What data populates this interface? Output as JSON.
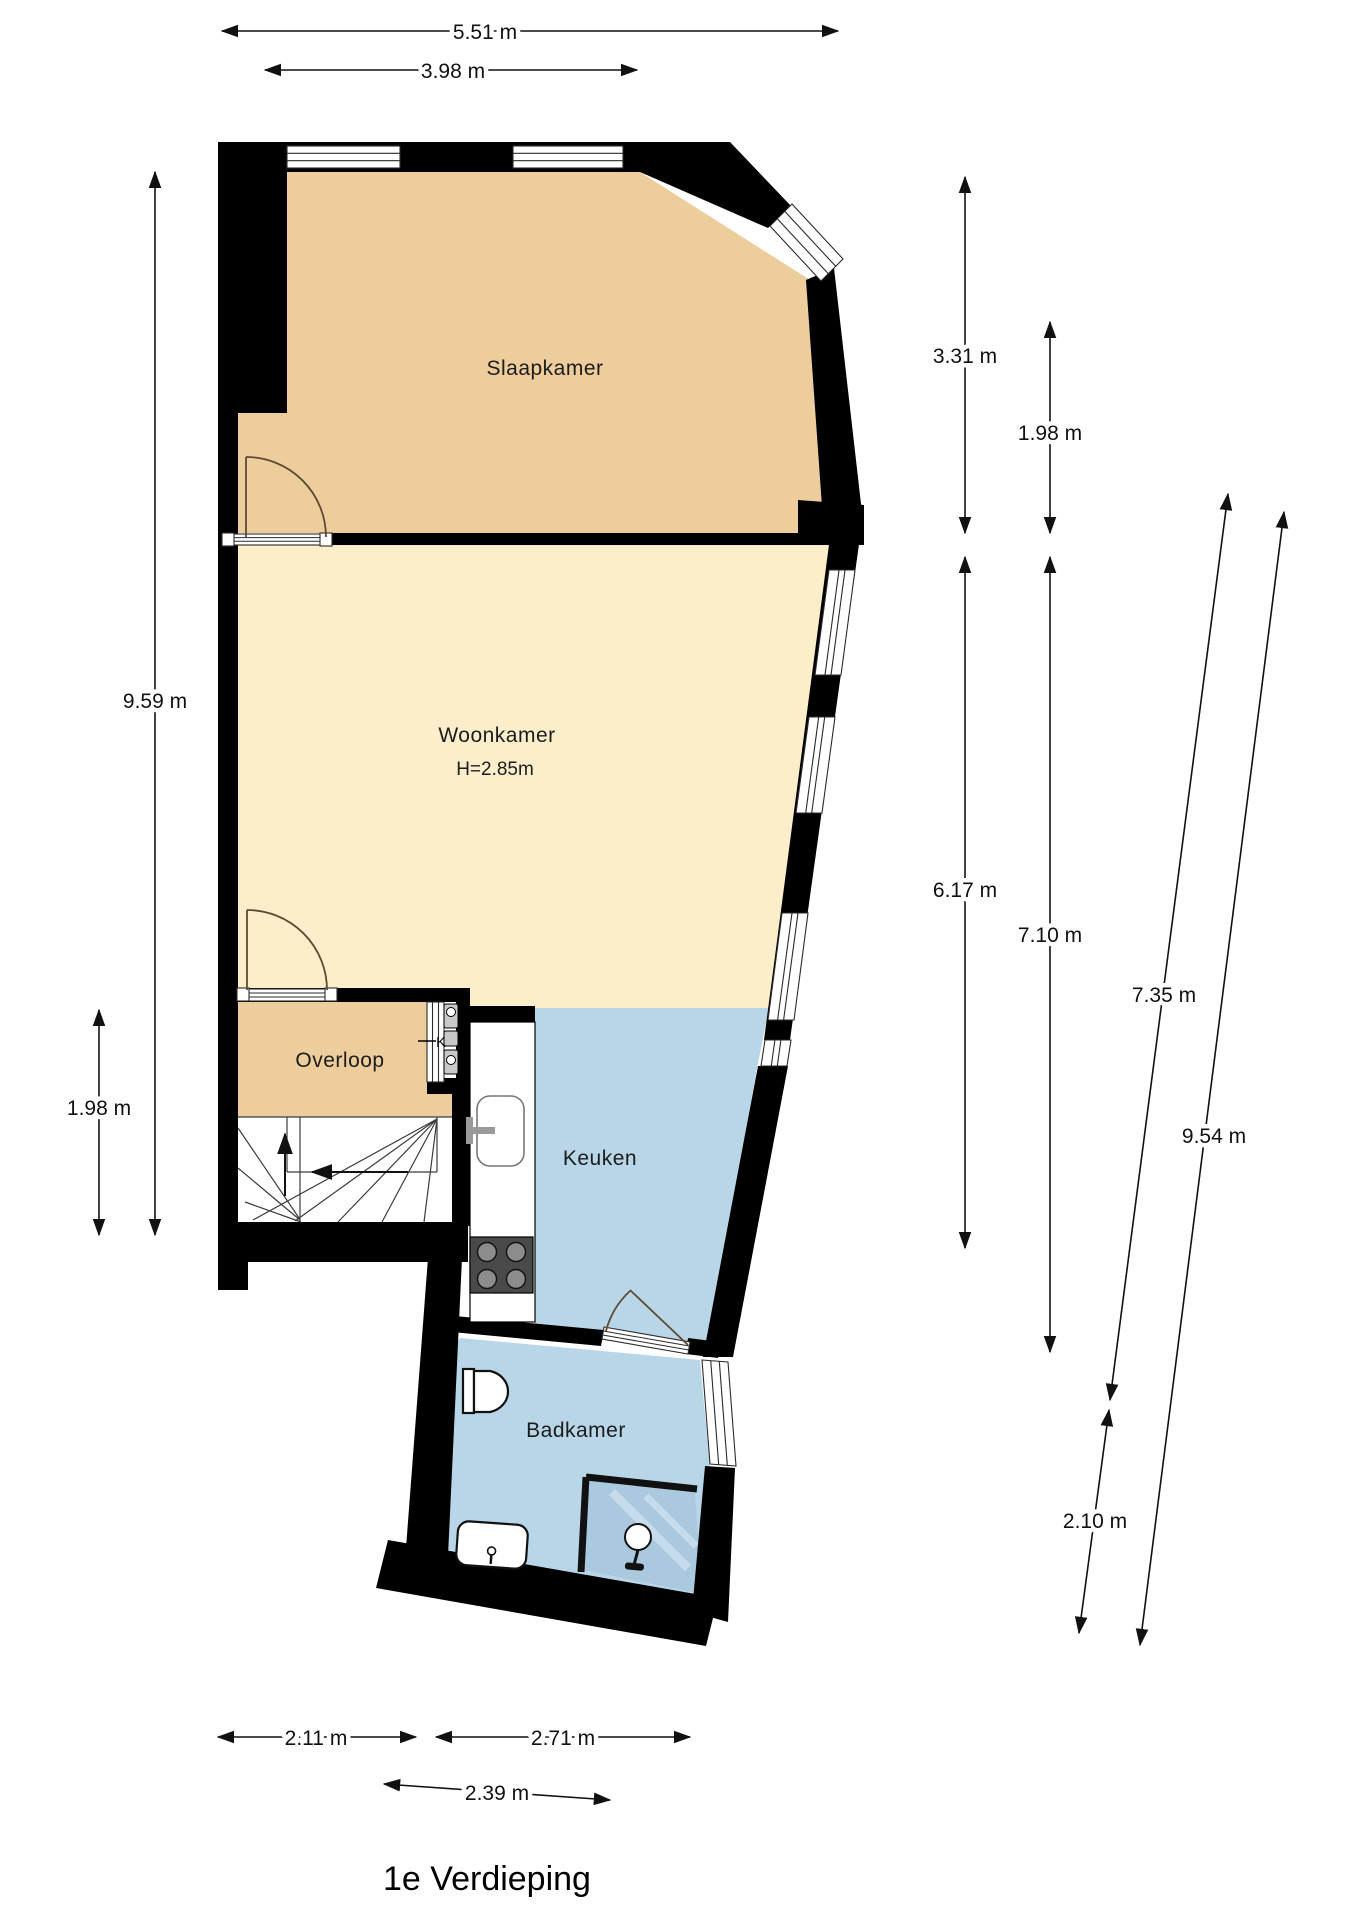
{
  "title": "1e Verdieping",
  "rooms": {
    "slaapkamer": "Slaapkamer",
    "woonkamer": "Woonkamer",
    "woonkamer_height": "H=2.85m",
    "overloop": "Overloop",
    "keuken": "Keuken",
    "badkamer": "Badkamer"
  },
  "labels": {
    "meter_cabinet": "K"
  },
  "dims": {
    "top_outer": "5.51 m",
    "top_inner": "3.98 m",
    "left_outer": "9.59 m",
    "left_inner": "1.98 m",
    "right_inner_top": "3.31 m",
    "right_inner_top2": "1.98 m",
    "right_inner_mid": "6.17 m",
    "right_inner_mid2": "7.10 m",
    "right_outer": "7.35 m",
    "right_outer2": "9.54 m",
    "right_outer3": "2.10 m",
    "bottom_left": "2.11 m",
    "bottom_right": "2.71 m",
    "bottom_inner": "2.39 m"
  },
  "colors": {
    "wall": "#000000",
    "bedroom_fill": "#eecd9c",
    "living_fill": "#fdeecb",
    "wet_fill": "#b9d6e8",
    "shower_fill": "#abc9de",
    "stove_fill": "#4a4a4a",
    "burner_fill": "#8c8c8c",
    "cabinet_fill": "#c8c8c8"
  }
}
